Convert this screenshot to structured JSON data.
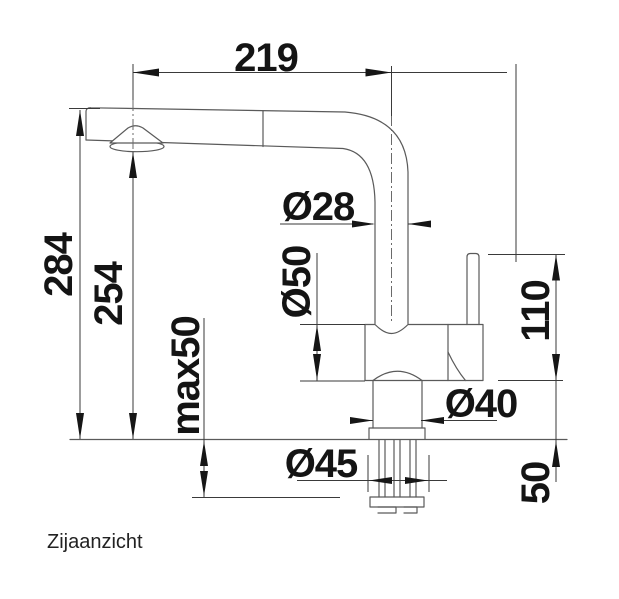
{
  "caption": "Zijaanzicht",
  "dimensions": {
    "spout_reach": "219",
    "total_height": "284",
    "spout_height": "254",
    "max_counter_thickness": "max50",
    "spout_diameter": "Ø28",
    "body_diameter": "Ø50",
    "neck_diameter": "Ø40",
    "hole_diameter": "Ø45",
    "handle_height": "110",
    "shank_depth": "50"
  },
  "colors": {
    "background": "#ffffff",
    "outline": "#5a5a5a",
    "dimension_lines": "#3a3a3a",
    "arrow_fill": "#161616",
    "text": "#141414"
  }
}
